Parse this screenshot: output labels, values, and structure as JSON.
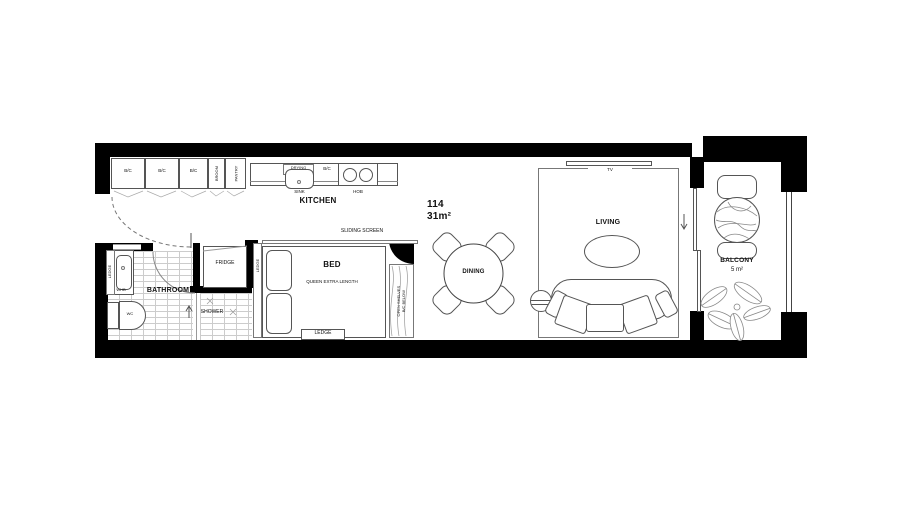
{
  "unit": {
    "number": "114",
    "area_label": "31m²"
  },
  "kitchen": {
    "name": "KITCHEN",
    "cabinets": [
      {
        "label": "B/C"
      },
      {
        "label": "B/C"
      },
      {
        "label": "B/C"
      },
      {
        "label": "BROOM"
      },
      {
        "label": "PANTRY"
      }
    ],
    "drying_label": "DRYING",
    "sink_label": "SINK",
    "counter_cabinet_label": "B/C",
    "hob_label": "HOB"
  },
  "bathroom": {
    "name": "BATHROOM",
    "ledge_label": "LEDGE",
    "basin_label": "WHB",
    "wc_label": "WC",
    "shower_label": "SHOWER"
  },
  "hall": {
    "fridge_label": "FRIDGE"
  },
  "bedroom": {
    "name": "BED",
    "bed_type": "QUEEN EXTRA LENGTH",
    "sliding_screen_label": "SLIDING SCREEN",
    "ledge_side_label": "LEDGE",
    "ledge_foot_label": "LEDGE",
    "shelves_label_line1": "OPEN SHELVES",
    "shelves_label_line2": "B/C BELOW"
  },
  "dining": {
    "name": "DINING"
  },
  "living": {
    "name": "LIVING",
    "tv_label": "TV"
  },
  "balcony": {
    "name": "BALCONY",
    "area_label": "5 m²"
  },
  "colors": {
    "wall": "#000000",
    "furniture_line": "#555555",
    "tile_line": "#cccccc"
  }
}
